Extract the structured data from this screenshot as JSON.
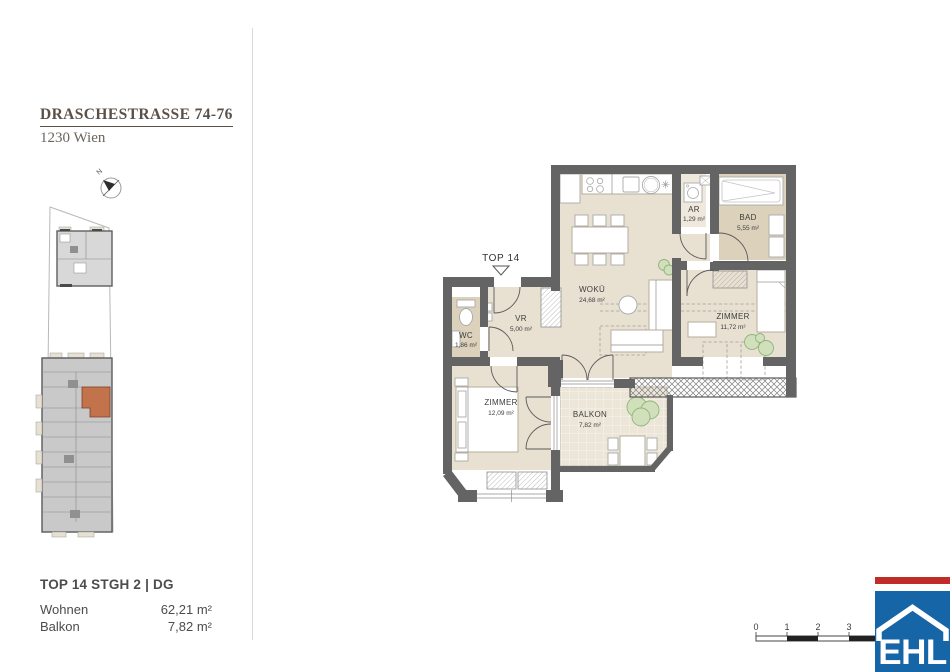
{
  "header": {
    "street": "DRASCHESTRASSE 74-76",
    "city": "1230 Wien"
  },
  "compass": {
    "north_label": "N"
  },
  "plan": {
    "unit_marker": "TOP 14",
    "rooms": [
      {
        "name": "WOKÜ",
        "area": "24,68 m²"
      },
      {
        "name": "AR",
        "area": "1,29 m²"
      },
      {
        "name": "BAD",
        "area": "5,55 m²"
      },
      {
        "name": "ZIMMER",
        "area": "11,72 m²"
      },
      {
        "name": "WC",
        "area": "1,86 m²"
      },
      {
        "name": "VR",
        "area": "5,00 m²"
      },
      {
        "name": "ZIMMER",
        "area": "12,09 m²"
      },
      {
        "name": "BALKON",
        "area": "7,82 m²"
      }
    ]
  },
  "unit_info": {
    "title": "TOP 14 STGH 2 | DG",
    "rows": [
      {
        "label": "Wohnen",
        "value": "62,21 m²"
      },
      {
        "label": "Balkon",
        "value": "7,82 m²"
      }
    ]
  },
  "scale_bar": {
    "labels": [
      "0",
      "1",
      "2",
      "3"
    ]
  },
  "logo": {
    "text": "EHL"
  },
  "colors": {
    "wall": "#646464",
    "floor": "#e8e1d2",
    "floor_dark": "#dcd2bc",
    "floor_light": "#efe9dd",
    "balcony_floor": "#ece6d8",
    "furniture_stroke": "#b6ad9c",
    "plant_fill": "#cfe0ba",
    "plant_stroke": "#93b27e",
    "highlight": "#c3734b",
    "logo_blue": "#1565a7",
    "logo_red": "#c02d28",
    "text_dark": "#3d3d3d",
    "text_title": "#5a5048"
  }
}
